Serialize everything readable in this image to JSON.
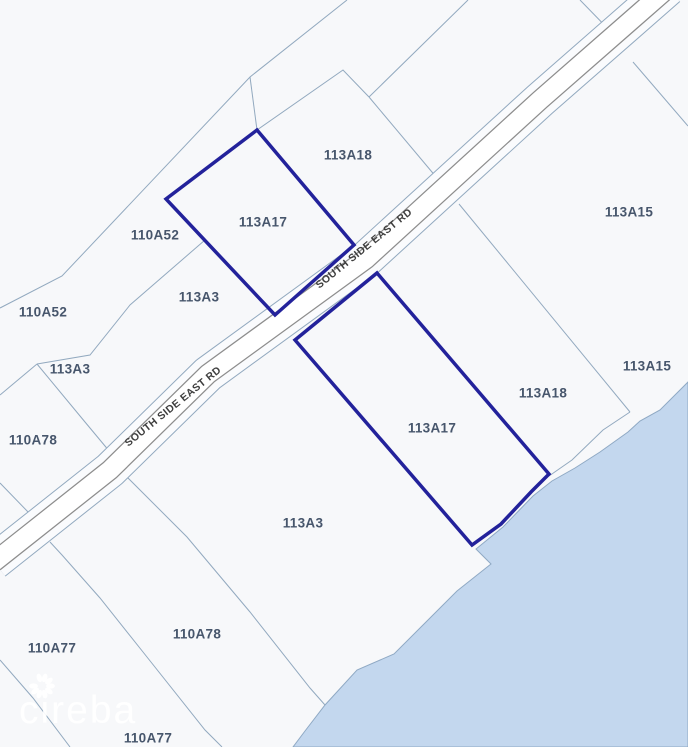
{
  "map": {
    "width": 688,
    "height": 747,
    "background_color": "#f7f8fa",
    "parcel_line_color": "#92a9bf",
    "label_color": "#47566c",
    "highlight_color": "#23229b",
    "water": {
      "fill_color": "#c3d7ee",
      "edge_color": "#8fa9c4",
      "polygon": [
        [
          688,
          382
        ],
        [
          660,
          410
        ],
        [
          640,
          421
        ],
        [
          628,
          432
        ],
        [
          600,
          452
        ],
        [
          575,
          468
        ],
        [
          552,
          481
        ],
        [
          533,
          496
        ],
        [
          503,
          527
        ],
        [
          476,
          549
        ],
        [
          491,
          564
        ],
        [
          457,
          591
        ],
        [
          427,
          621
        ],
        [
          394,
          654
        ],
        [
          357,
          670
        ],
        [
          325,
          705
        ],
        [
          305,
          731
        ],
        [
          293,
          747
        ],
        [
          688,
          747
        ]
      ]
    },
    "road": {
      "name": "SOUTH SIDE EAST RD",
      "surface_color": "#ffffff",
      "casing_color": "#8d8d8d",
      "corridor_color": "#fafbfd",
      "centerline": [
        [
          -6,
          562
        ],
        [
          110,
          470
        ],
        [
          208,
          374
        ],
        [
          366,
          259
        ],
        [
          540,
          100
        ],
        [
          668,
          -12
        ]
      ],
      "labels": [
        {
          "text": "SOUTH SIDE EAST RD",
          "x": 175,
          "y": 409,
          "rotation": -39
        },
        {
          "text": "SOUTH SIDE EAST RD",
          "x": 366,
          "y": 251,
          "rotation": -39
        }
      ],
      "label_color": "#3e3e3e"
    },
    "boundary_lines": [
      {
        "name": "north-long-boundary",
        "points": [
          [
            347,
            0
          ],
          [
            250,
            77
          ],
          [
            62,
            276
          ],
          [
            0,
            308
          ]
        ]
      },
      {
        "name": "north-connector",
        "points": [
          [
            250,
            77
          ],
          [
            257,
            130
          ]
        ]
      },
      {
        "name": "northeast-boundary",
        "points": [
          [
            257,
            130
          ],
          [
            343,
            70
          ],
          [
            369,
            97
          ]
        ]
      },
      {
        "name": "northeast-upper-boundary",
        "points": [
          [
            468,
            0
          ],
          [
            369,
            97
          ]
        ]
      },
      {
        "name": "northeast-road-tail",
        "points": [
          [
            369,
            97
          ],
          [
            437,
            178
          ]
        ]
      },
      {
        "name": "west-strip-boundary",
        "points": [
          [
            205,
            240
          ],
          [
            130,
            305
          ],
          [
            90,
            355
          ],
          [
            37,
            364
          ]
        ]
      },
      {
        "name": "west-peak-left",
        "points": [
          [
            37,
            364
          ],
          [
            0,
            395
          ]
        ]
      },
      {
        "name": "west-peak-right",
        "points": [
          [
            37,
            364
          ],
          [
            85,
            422
          ],
          [
            110,
            452
          ]
        ]
      },
      {
        "name": "west-edge-segment",
        "points": [
          [
            0,
            483
          ],
          [
            30,
            514
          ]
        ]
      },
      {
        "name": "south-center-boundary",
        "points": [
          [
            124,
            474
          ],
          [
            187,
            537
          ],
          [
            250,
            612
          ],
          [
            310,
            688
          ],
          [
            325,
            705
          ]
        ]
      },
      {
        "name": "southwest-boundary",
        "points": [
          [
            50,
            542
          ],
          [
            62,
            555
          ],
          [
            100,
            598
          ],
          [
            143,
            652
          ],
          [
            205,
            730
          ],
          [
            222,
            747
          ]
        ]
      },
      {
        "name": "southwest-edge-boundary",
        "points": [
          [
            0,
            660
          ],
          [
            33,
            698
          ],
          [
            70,
            747
          ]
        ]
      },
      {
        "name": "topright-boundary-upper",
        "points": [
          [
            580,
            0
          ],
          [
            617,
            38
          ]
        ]
      },
      {
        "name": "topright-boundary-lower",
        "points": [
          [
            633,
            62
          ],
          [
            688,
            126
          ]
        ]
      },
      {
        "name": "east-boundary",
        "points": [
          [
            459,
            204
          ],
          [
            630,
            412
          ]
        ]
      },
      {
        "name": "coastal-inland-line",
        "points": [
          [
            630,
            412
          ],
          [
            603,
            430
          ],
          [
            572,
            460
          ],
          [
            549,
            476
          ]
        ]
      }
    ],
    "highlighted_parcels": [
      {
        "id": "113A17-north",
        "points": [
          [
            257,
            130
          ],
          [
            354,
            245
          ],
          [
            275,
            315
          ],
          [
            166,
            199
          ]
        ]
      },
      {
        "id": "113A17-south",
        "points": [
          [
            377,
            273
          ],
          [
            549,
            474
          ],
          [
            531,
            492
          ],
          [
            501,
            524
          ],
          [
            472,
            545
          ],
          [
            295,
            340
          ]
        ]
      }
    ],
    "labels": [
      {
        "text": "113A18",
        "x": 348,
        "y": 156
      },
      {
        "text": "113A17",
        "x": 263,
        "y": 223
      },
      {
        "text": "110A52",
        "x": 155,
        "y": 236
      },
      {
        "text": "113A15",
        "x": 629,
        "y": 213
      },
      {
        "text": "113A3",
        "x": 199,
        "y": 298
      },
      {
        "text": "110A52",
        "x": 43,
        "y": 313
      },
      {
        "text": "113A3",
        "x": 70,
        "y": 370
      },
      {
        "text": "113A15",
        "x": 647,
        "y": 367
      },
      {
        "text": "113A18",
        "x": 543,
        "y": 394
      },
      {
        "text": "110A78",
        "x": 33,
        "y": 441
      },
      {
        "text": "113A17",
        "x": 432,
        "y": 429
      },
      {
        "text": "113A3",
        "x": 303,
        "y": 524
      },
      {
        "text": "110A78",
        "x": 197,
        "y": 635
      },
      {
        "text": "110A77",
        "x": 52,
        "y": 649
      },
      {
        "text": "110A77",
        "x": 148,
        "y": 739
      }
    ]
  },
  "watermark": {
    "text": "cireba",
    "color": "rgba(255,255,255,0.92)"
  }
}
